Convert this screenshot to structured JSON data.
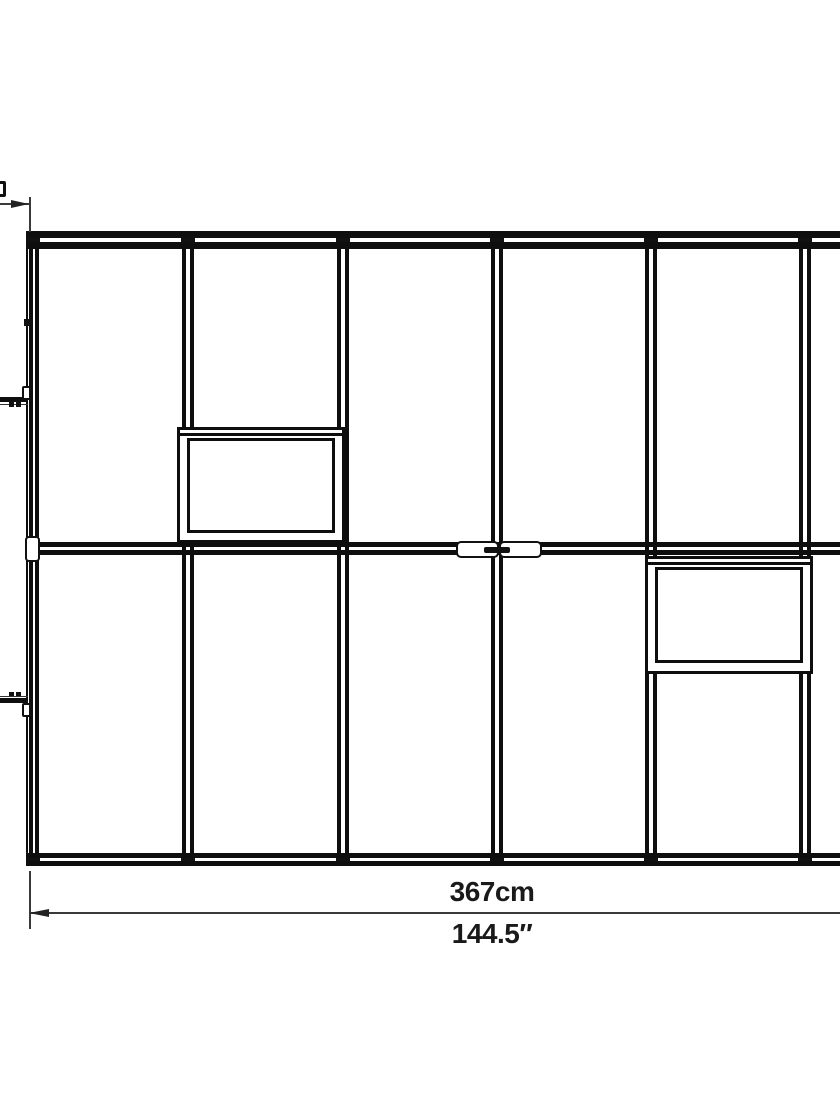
{
  "diagram": {
    "type": "greenhouse-frame-plan-drawing",
    "labels": {
      "dim_metric": "367cm",
      "dim_imperial": "144.5″"
    },
    "colors": {
      "background": "#ffffff",
      "frame_line": "#0e0e0e",
      "dimension_line": "#3a3a3a",
      "text": "#1a1a1a"
    }
  }
}
